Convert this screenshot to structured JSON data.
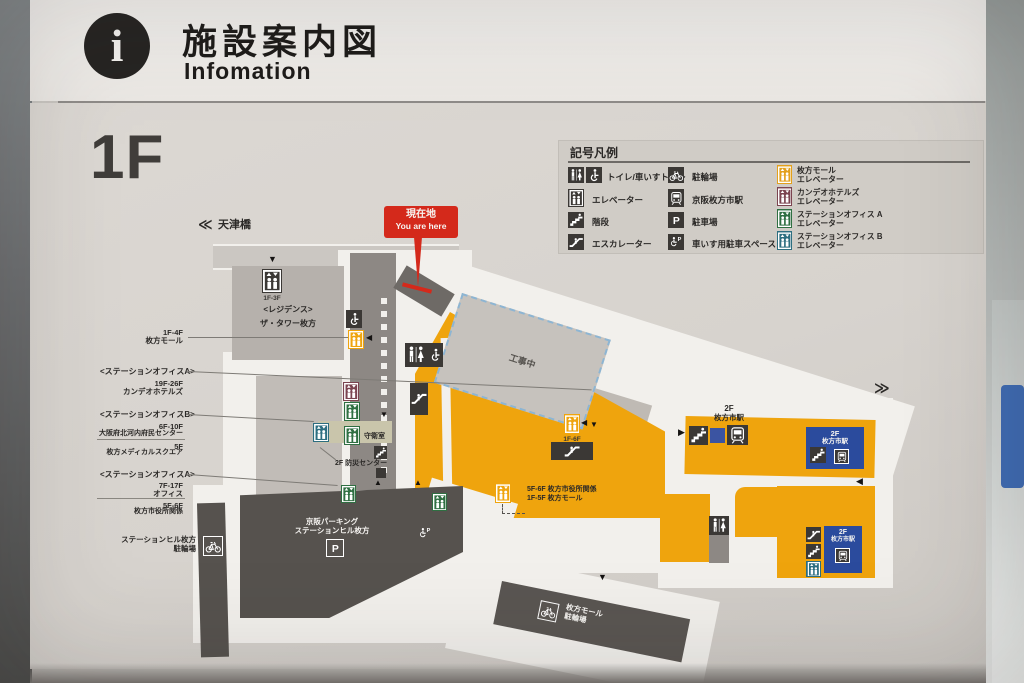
{
  "header": {
    "title_ja": "施設案内図",
    "title_en": "Infomation"
  },
  "floor": "1F",
  "legend": {
    "title": "記号凡例",
    "col1": [
      {
        "label": "トイレ/車いすトイレ"
      },
      {
        "label": "エレベーター"
      },
      {
        "label": "階段"
      },
      {
        "label": "エスカレーター"
      }
    ],
    "col2": [
      {
        "label": "駐輪場"
      },
      {
        "label": "京阪枚方市駅"
      },
      {
        "label": "駐車場"
      },
      {
        "label": "車いす用駐車スペース"
      }
    ],
    "col3": [
      {
        "line1": "枚方モール",
        "line2": "エレベーター",
        "color": "#e3a01b"
      },
      {
        "line1": "カンデオホテルズ",
        "line2": "エレベーター",
        "color": "#7b4450"
      },
      {
        "line1": "ステーションオフィス A",
        "line2": "エレベーター",
        "color": "#2f6f42"
      },
      {
        "line1": "ステーションオフィス B",
        "line2": "エレベーター",
        "color": "#2d6e80"
      }
    ]
  },
  "map": {
    "you_are_here_ja": "現在地",
    "you_are_here_en": "You are here",
    "nav_left": "天津橋",
    "nav_right": "枚方モール A〜C",
    "residence": {
      "name1": "<レジデンス>",
      "name2": "ザ・タワー枚方",
      "elevator_floors": "1F-3F"
    },
    "label_mall": {
      "l1": "1F-4F",
      "l2": "枚方モール"
    },
    "label_officeA_hotel": {
      "title": "<ステーションオフィスA>",
      "l1": "19F-26F",
      "l2": "カンデオホテルズ"
    },
    "label_officeB": {
      "title": "<ステーションオフィスB>",
      "l1": "6F-10F",
      "l2": "大阪府北河内府民センター",
      "l3": "5F",
      "l4": "枚方メディカルスクエア"
    },
    "label_officeA_office": {
      "title": "<ステーションオフィスA>",
      "l1": "7F-17F",
      "l2": "オフィス",
      "l3": "5F-6F",
      "l4": "枚方市役所関係"
    },
    "label_hill_bicycle": {
      "l1": "ステーションヒル枚方",
      "l2": "駐輪場"
    },
    "construction": "工事中",
    "guard_room": "守衛室",
    "disaster_center": "2F 防災センター",
    "cityhall_note": {
      "l1": "5F-6F 枚方市役所関係",
      "l2": "1F-5F 枚方モール"
    },
    "elevator_1f6f": "1F-6F",
    "parking": {
      "l1": "京阪パーキング",
      "l2": "ステーションヒル枚方"
    },
    "mall_bicycle": {
      "l1": "枚方モール",
      "l2": "駐輪場"
    },
    "station_top": {
      "l1": "2F",
      "l2": "枚方市駅"
    },
    "station_box1": {
      "l1": "2F",
      "l2": "枚方市駅"
    },
    "station_box2": {
      "l1": "2F",
      "l2": "枚方市駅"
    }
  },
  "colors": {
    "mall_orange": "#efa40d",
    "station_blue": "#2b4b9d",
    "office_a_green": "#2f6f42",
    "office_b_teal": "#2d6e80",
    "hotel_maroon": "#7b4450",
    "marker_red": "#d4291b",
    "dark_structure": "#56524e"
  }
}
